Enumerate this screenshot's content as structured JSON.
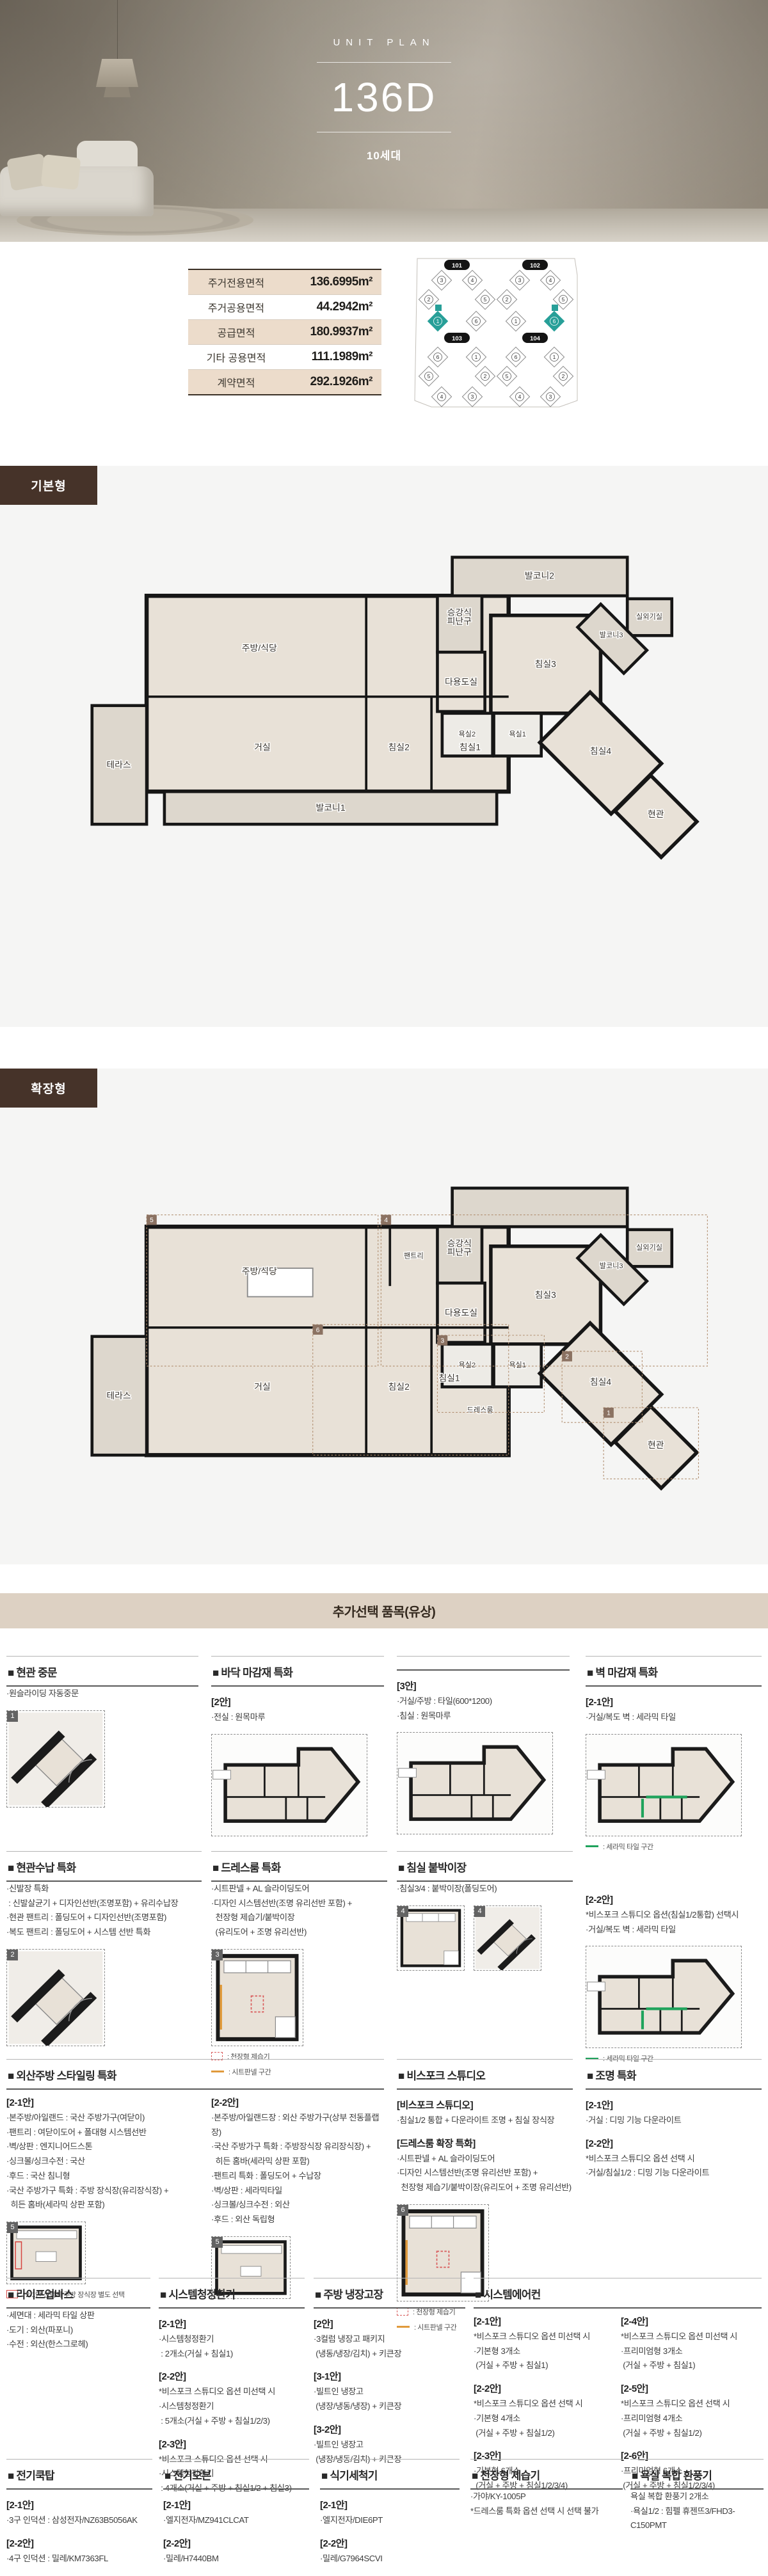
{
  "hero": {
    "eyebrow": "UNIT PLAN",
    "title": "136D",
    "subtitle": "10세대"
  },
  "area_table": {
    "rows": [
      {
        "label": "주거전용면적",
        "value": "136.6995m²"
      },
      {
        "label": "주거공용면적",
        "value": "44.2942m²"
      },
      {
        "label": "공급면적",
        "value": "180.9937m²"
      },
      {
        "label": "기타 공용면적",
        "value": "111.1989m²"
      },
      {
        "label": "계약면적",
        "value": "292.1926m²"
      }
    ]
  },
  "key_plan": {
    "highlight_color": "#279f98",
    "buildings": [
      {
        "id": "101",
        "units": [
          "3",
          "4",
          "2",
          "5",
          "1",
          "6"
        ],
        "highlight": "1",
        "row": "top"
      },
      {
        "id": "102",
        "units": [
          "3",
          "4",
          "2",
          "5",
          "1",
          "6"
        ],
        "highlight": "6",
        "row": "top"
      },
      {
        "id": "103",
        "units": [
          "6",
          "1",
          "5",
          "2",
          "4",
          "3"
        ],
        "highlight": "",
        "row": "bottom"
      },
      {
        "id": "104",
        "units": [
          "6",
          "1",
          "5",
          "2",
          "4",
          "3"
        ],
        "highlight": "",
        "row": "bottom"
      }
    ]
  },
  "plans": [
    {
      "label": "기본형",
      "rooms": [
        "주방/식당",
        "다용도실",
        "승강식|피난구",
        "발코니2",
        "실외기실",
        "침실3",
        "발코니3",
        "침실4",
        "욕실2",
        "욕실1",
        "현관",
        "거실",
        "침실2",
        "침실1",
        "발코니1",
        "테라스"
      ]
    },
    {
      "label": "확장형",
      "rooms": [
        "주방/식당",
        "팬트리",
        "다용도실",
        "승강식|피난구",
        "침실3",
        "실외기실",
        "발코니3",
        "침실4",
        "욕실2",
        "욕실1",
        "드레스룸",
        "현관",
        "거실",
        "침실2",
        "침실1",
        "테라스"
      ],
      "zone_numbers": [
        "1",
        "2",
        "3",
        "4",
        "5",
        "6"
      ]
    }
  ],
  "options": {
    "header": "추가선택 품목(유상)",
    "sections": [
      {
        "id": "entrance-door",
        "title": "■ 현관 중문",
        "cols": [
          {
            "blocks": [
              {
                "lines": [
                  "·원슬라이딩 자동중문"
                ]
              }
            ],
            "thumbs": [
              {
                "n": "1",
                "kind": "corner"
              }
            ]
          }
        ]
      },
      {
        "id": "floor-finish-a",
        "title": "■ 바닥 마감재 특화",
        "cols": [
          {
            "blocks": [
              {
                "tag": "[2안]",
                "lines": [
                  "·전실 : 원목마루"
                ]
              }
            ],
            "thumbs": [
              {
                "kind": "fullplan"
              }
            ]
          }
        ]
      },
      {
        "id": "floor-finish-b",
        "title": "",
        "cols": [
          {
            "blocks": [
              {
                "tag": "[3안]",
                "lines": [
                  "·거실/주방 : 타일(600*1200)",
                  "·침실 : 원목마루"
                ]
              }
            ],
            "thumbs": [
              {
                "kind": "fullplan"
              }
            ]
          }
        ]
      },
      {
        "id": "wall-finish-a",
        "title": "■ 벽 마감재 특화",
        "cols": [
          {
            "blocks": [
              {
                "tag": "[2-1안]",
                "lines": [
                  "·거실/복도 벽 : 세라믹 타일"
                ]
              }
            ],
            "thumbs": [
              {
                "kind": "fullplan",
                "accent": "green"
              }
            ],
            "legends": [
              {
                "sw": "line",
                "color": "#1fa35c",
                "label": ": 세라믹 타일 구간"
              }
            ]
          }
        ]
      },
      {
        "id": "entrance-storage",
        "title": "■ 현관수납 특화",
        "cols": [
          {
            "blocks": [
              {
                "lines": [
                  "·신발장 특화",
                  " : 신발살균기 + 디자인선반(조명포함) + 유리수납장",
                  "·현관 팬트리 : 폴딩도어 + 디자인선반(조명포함)",
                  "·복도 팬트리 : 폴딩도어 + 시스템 선반 특화"
                ]
              }
            ],
            "thumbs": [
              {
                "n": "2",
                "kind": "corner"
              }
            ]
          }
        ]
      },
      {
        "id": "dressroom",
        "title": "■ 드레스룸 특화",
        "cols": [
          {
            "blocks": [
              {
                "lines": [
                  "·시트판넬 + AL 슬라이딩도어",
                  "·디자인 시스템선반(조명 유리선반 포함) +",
                  "  천장형 제습기/붙박이장",
                  "  (유리도어 + 조명 유리선반)"
                ]
              }
            ],
            "thumbs": [
              {
                "n": "3",
                "kind": "room",
                "accent": "both"
              }
            ],
            "legends": [
              {
                "sw": "dashbox",
                "color": "#d95b5b",
                "label": ": 천장형 제습기"
              },
              {
                "sw": "line",
                "color": "#e09a3c",
                "label": ": 시트판넬 구간"
              }
            ]
          }
        ]
      },
      {
        "id": "bedroom-closet",
        "title": "■ 침실 붙박이장",
        "cols": [
          {
            "blocks": [
              {
                "lines": [
                  "·침실3/4 : 붙박이장(폴딩도어)"
                ]
              }
            ],
            "thumbs": [
              {
                "n": "4",
                "kind": "room",
                "size": "sm"
              },
              {
                "n": "4",
                "kind": "corner",
                "size": "sm"
              }
            ]
          }
        ]
      },
      {
        "id": "wall-finish-b",
        "title": null,
        "cols": [
          {
            "blocks": [
              {
                "tag": "[2-2안]",
                "lines": [
                  "*비스포크 스튜디오 옵션(침실1/2통합) 선택시",
                  "·거실/복도 벽 : 세라믹 타일"
                ]
              }
            ],
            "thumbs": [
              {
                "kind": "fullplan",
                "accent": "green"
              }
            ],
            "legends": [
              {
                "sw": "line",
                "color": "#1fa35c",
                "label": ": 세라믹 타일 구간"
              }
            ]
          }
        ]
      },
      {
        "id": "import-kitchen",
        "title": "■ 외산주방 스타일링 특화",
        "cols": [
          {
            "blocks": [
              {
                "tag": "[2-1안]",
                "lines": [
                  "·본주방/아일랜드 : 국산 주방가구(여닫이)",
                  "·팬트리 : 여닫이도어 + 폴대형 시스템선반",
                  "·벽/상판 : 엔지니어드스톤",
                  "·싱크볼/싱크수전 : 국산",
                  "·후드 : 국산 침니형",
                  "·국산 주방가구 특화 : 주방 장식장(유리장식장) +",
                  "  히든 홈바(세라믹 상판 포함)"
                ]
              }
            ],
            "thumbs": [
              {
                "n": "5",
                "kind": "kitchen",
                "accent": "red"
              }
            ],
            "legends": [
              {
                "sw": "box",
                "color": "#d64541",
                "label": ": 2-1안 선택시 주방 장식장 별도 선택"
              }
            ]
          },
          {
            "blocks": [
              {
                "tag": "[2-2안]",
                "lines": [
                  "·본주방/아일랜드장 : 외산 주방가구(상부 전동플랩장)",
                  "·국산 주방가구 특화 : 주방장식장 유리장식장) +",
                  "  히든 홈바(세라믹 상판 포함)",
                  "·팬트리 특화 : 폴딩도어 + 수납장",
                  "·벽/상판 : 세라믹타일",
                  "·싱크볼/싱크수전 : 외산",
                  "·후드 : 외산 독립형"
                ]
              }
            ],
            "thumbs": [
              {
                "n": "5",
                "kind": "kitchen"
              }
            ]
          }
        ]
      },
      {
        "id": "bespoke-studio",
        "title": "■ 비스포크 스튜디오",
        "cols": [
          {
            "blocks": [
              {
                "tag": "[비스포크 스튜디오]",
                "lines": [
                  "·침실1/2 통합 + 다운라이트 조명 + 침실 장식장"
                ]
              },
              {
                "tag": "[드레스룸 확장 특화]",
                "lines": [
                  "·시트판넬 + AL 슬라이딩도어",
                  "·디자인 시스템선반(조명 유리선반 포함) +",
                  "  천장형 제습기/붙박이장(유리도어 + 조명 유리선반)"
                ]
              }
            ],
            "thumbs": [
              {
                "n": "6",
                "kind": "room",
                "accent": "both"
              }
            ],
            "legends": [
              {
                "sw": "dashbox",
                "color": "#d95b5b",
                "label": ": 천장형 제습기"
              },
              {
                "sw": "line",
                "color": "#e09a3c",
                "label": ": 시트판넬 구간"
              }
            ]
          }
        ]
      },
      {
        "id": "lighting",
        "title": "■ 조명 특화",
        "cols": [
          {
            "blocks": [
              {
                "tag": "[2-1안]",
                "lines": [
                  "·거실 : 디밍 기능 다운라이트"
                ]
              },
              {
                "tag": "[2-2안]",
                "lines": [
                  "*비스포크 스튜디오 옵션 선택 시",
                  "·거실/침실1/2 : 디밍 기능 다운라이트"
                ]
              }
            ]
          }
        ]
      },
      {
        "id": "lifeup-bath",
        "title": "■ 라이프업바스",
        "cols": [
          {
            "blocks": [
              {
                "lines": [
                  "·세면대 : 세라믹 타일 상판",
                  "·도기 : 외산(파포니)",
                  "·수전 : 외산(한스그로헤)"
                ]
              }
            ]
          }
        ]
      },
      {
        "id": "air-purifier-vent",
        "title": "■ 시스템청정환기",
        "cols": [
          {
            "blocks": [
              {
                "tag": "[2-1안]",
                "lines": [
                  "·시스템청정환기",
                  " : 2개소(거실 + 침실1)"
                ]
              },
              {
                "tag": "[2-2안]",
                "lines": [
                  "*비스포크 스튜디오 옵션 미선택 시",
                  "·시스템청정환기",
                  " : 5개소(거실 + 주방 + 침실1/2/3)"
                ]
              },
              {
                "tag": "[2-3안]",
                "lines": [
                  "*비스포크 스튜디오 옵션 선택 시",
                  "·시스템청정환기",
                  " : 4개소(거실 + 주방 + 침실1/2 + 침실3)"
                ]
              }
            ]
          }
        ]
      },
      {
        "id": "kitchen-fridge",
        "title": "■ 주방 냉장고장",
        "cols": [
          {
            "blocks": [
              {
                "tag": "[2안]",
                "lines": [
                  "·3컬럼 냉장고 패키지",
                  " (냉동/냉장/김치) + 키큰장"
                ]
              },
              {
                "tag": "[3-1안]",
                "lines": [
                  "·빌트인 냉장고",
                  " (냉장/냉동/냉장) + 키큰장"
                ]
              },
              {
                "tag": "[3-2안]",
                "lines": [
                  "·빌트인 냉장고",
                  " (냉장/냉동/김치) + 키큰장"
                ]
              }
            ]
          }
        ]
      },
      {
        "id": "system-aircon",
        "title": "■ 시스템에어컨",
        "cols": [
          {
            "blocks": [
              {
                "tag": "[2-1안]",
                "lines": [
                  "*비스포크 스튜디오 옵션 미선택 시",
                  "·기본형 3개소",
                  " (거실 + 주방 + 침실1)"
                ]
              },
              {
                "tag": "[2-2안]",
                "lines": [
                  "*비스포크 스튜디오 옵션 선택 시",
                  "·기본형 4개소",
                  " (거실 + 주방 + 침실1/2)"
                ]
              },
              {
                "tag": "[2-3안]",
                "lines": [
                  "·기본형 6개소",
                  " (거실 + 주방 + 침실1/2/3/4)"
                ]
              }
            ]
          },
          {
            "blocks": [
              {
                "tag": "[2-4안]",
                "lines": [
                  "*비스포크 스튜디오 옵션 미선택 시",
                  "·프리미엄형 3개소",
                  " (거실 + 주방 + 침실1)"
                ]
              },
              {
                "tag": "[2-5안]",
                "lines": [
                  "*비스포크 스튜디오 옵션 선택 시",
                  "·프리미엄형 4개소",
                  " (거실 + 주방 + 침실1/2)"
                ]
              },
              {
                "tag": "[2-6안]",
                "lines": [
                  "·프리미엄형 6개소",
                  " (거실 + 주방 + 침실1/2/3/4)"
                ]
              }
            ]
          }
        ]
      },
      {
        "id": "cooktop",
        "title": "■ 전기쿡탑",
        "cols": [
          {
            "blocks": [
              {
                "tag": "[2-1안]",
                "lines": [
                  "·3구 인덕션 : 삼성전자/NZ63B5056AK"
                ]
              },
              {
                "tag": "[2-2안]",
                "lines": [
                  "·4구 인덕션 : 밀레/KM7363FL"
                ]
              }
            ]
          }
        ]
      },
      {
        "id": "oven",
        "title": "■ 전기오븐",
        "cols": [
          {
            "blocks": [
              {
                "tag": "[2-1안]",
                "lines": [
                  "·엘지전자/MZ941CLCAT"
                ]
              },
              {
                "tag": "[2-2안]",
                "lines": [
                  "·밀레/H7440BM"
                ]
              }
            ]
          }
        ]
      },
      {
        "id": "dishwasher",
        "title": "■ 식기세척기",
        "cols": [
          {
            "blocks": [
              {
                "tag": "[2-1안]",
                "lines": [
                  "·엘지전자/DIE6PT"
                ]
              },
              {
                "tag": "[2-2안]",
                "lines": [
                  "·밀레/G7964SCVI"
                ]
              }
            ]
          }
        ]
      },
      {
        "id": "ceiling-dehumidifier",
        "title": "■ 천장형 제습기",
        "cols": [
          {
            "blocks": [
              {
                "lines": [
                  "·가야/KY-1005P",
                  "*드레스룸 특화 옵션 선택 시 선택 불가"
                ]
              }
            ]
          }
        ]
      },
      {
        "id": "bath-fan",
        "title": "■ 욕실 복합 환풍기",
        "cols": [
          {
            "blocks": [
              {
                "lines": [
                  "욕실 복합 환풍기 2개소",
                  "·욕실1/2 : 힘펠 휴젠뜨3/FHD3-C150PMT"
                ]
              }
            ]
          }
        ]
      }
    ]
  }
}
